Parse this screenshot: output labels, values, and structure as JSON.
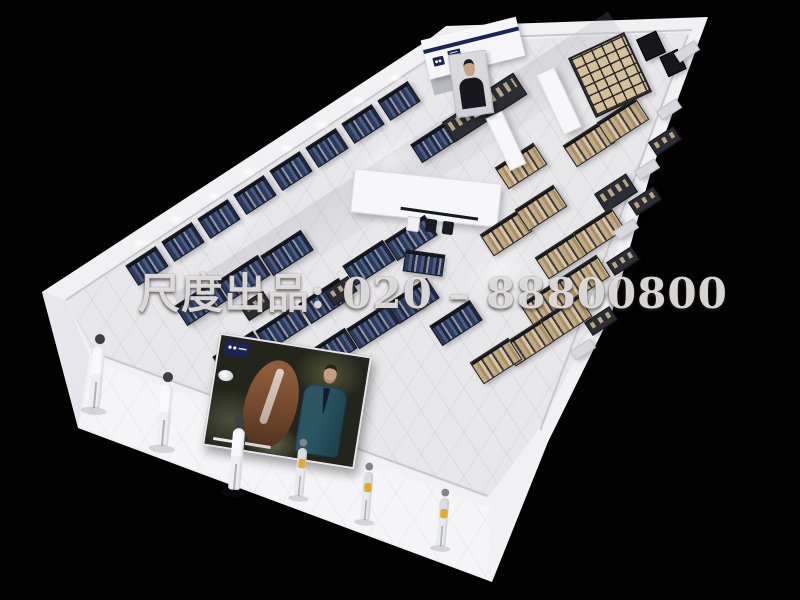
{
  "watermark": {
    "text": "尺度出品: 020 – 88800800"
  },
  "scene": {
    "subject": "3D top-down render of a menswear retail store floor plan",
    "adult_mannequins": 3,
    "child_mannequins": 3,
    "posters": 2
  },
  "colors": {
    "background": "#020202",
    "wall_white": "#f1f1f4",
    "floor_gray": "#e7e6e9",
    "brand_navy": "#1c2456",
    "clothing_navy": "#2b3a5e",
    "clothing_tan": "#c2ab80",
    "wood_shelf": "#d3c19c",
    "poster_suit_teal": "#2b5563",
    "horse_brown": "#8e5c3a",
    "accent_yellow": "#e3aa2f",
    "watermark_white": "#eeeceA"
  }
}
